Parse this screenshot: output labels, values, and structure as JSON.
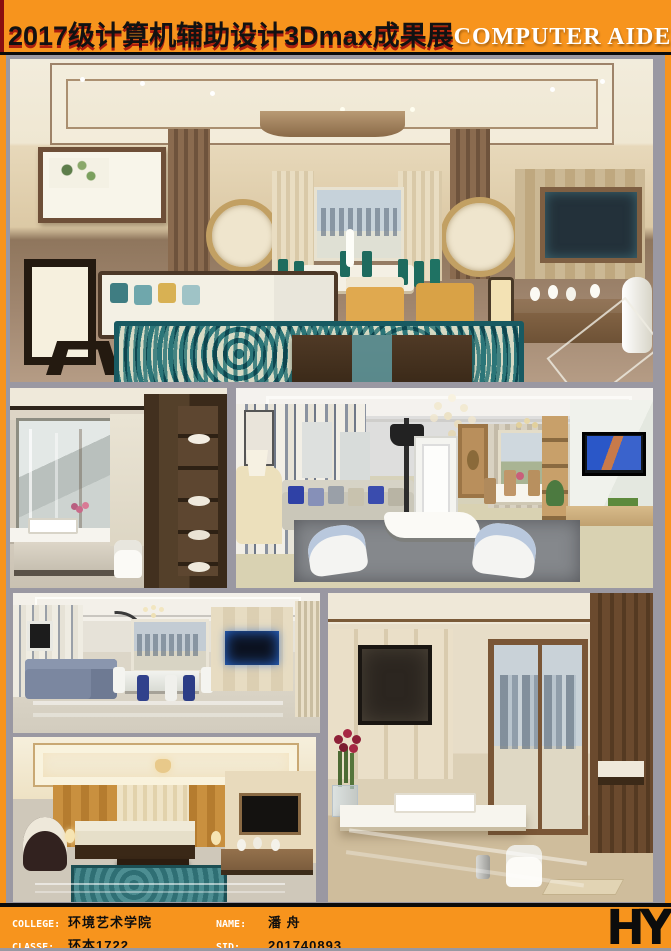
{
  "header": {
    "title_zh": "2017级计算机辅助设计3Dmax成果展",
    "title_en": "COMPUTER AIDED DESIGN"
  },
  "footer": {
    "college_label": "COLLEGE:",
    "college_value": "环境艺术学院",
    "classe_label": "CLASSE:",
    "classe_value": "环本1722",
    "name_label": "NAME:",
    "name_value": "潘 舟",
    "sid_label": "SID:",
    "sid_value": "201740893",
    "logo": "HY"
  },
  "colors": {
    "frame_orange": "#f7941d",
    "page_gray": "#9a98a2",
    "header_red_edge": "#8a0f0f",
    "divider_black": "#0b0b0b",
    "rug_teal": "#2e7d86",
    "accent_mustard": "#e0a94f"
  },
  "gallery": {
    "panels": [
      {
        "name": "render-neochinese-living-room"
      },
      {
        "name": "render-bathroom-vanity"
      },
      {
        "name": "render-living-room-chandelier"
      },
      {
        "name": "render-modern-living-dining"
      },
      {
        "name": "render-bathroom-cityview"
      },
      {
        "name": "render-chinese-living-room"
      }
    ]
  }
}
